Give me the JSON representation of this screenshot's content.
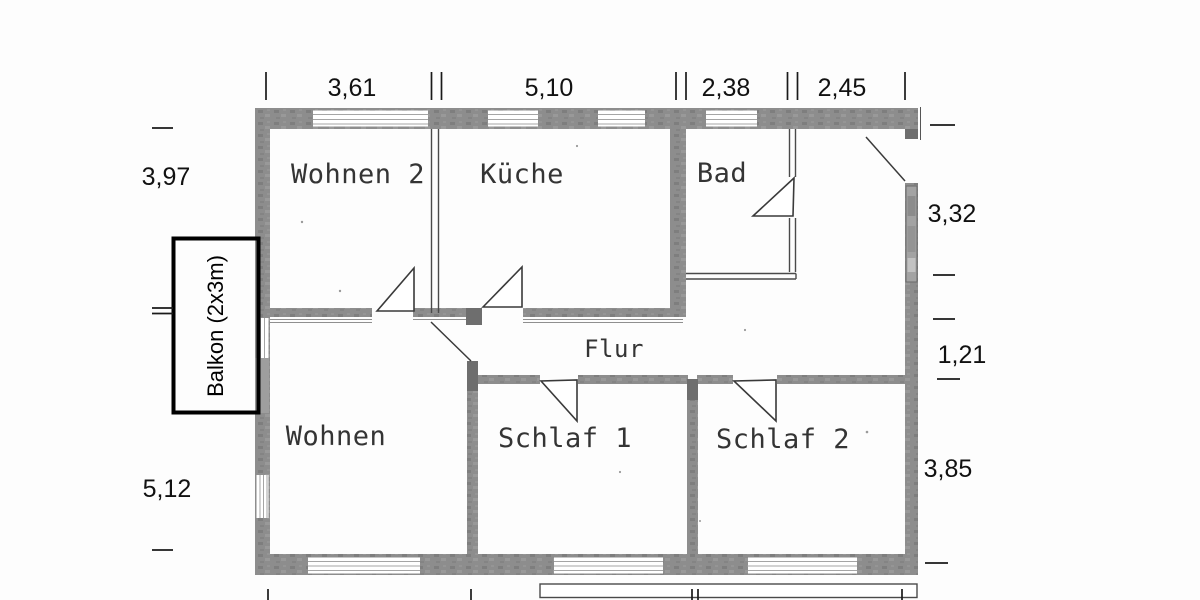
{
  "rooms": {
    "wohnen2": "Wohnen 2",
    "kueche": "Küche",
    "bad": "Bad",
    "flur": "Flur",
    "wohnen": "Wohnen",
    "schlaf1": "Schlaf 1",
    "schlaf2": "Schlaf 2"
  },
  "balcony": {
    "label": "Balkon (2x3m)"
  },
  "dimensions": {
    "top": [
      "3,61",
      "5,10",
      "2,38",
      "2,45"
    ],
    "left": [
      "3,97",
      "5,12"
    ],
    "right": [
      "3,32",
      "1,21",
      "3,85"
    ]
  },
  "colors": {
    "background": "#fdfdfd",
    "wall_gray": "#8d8d8d",
    "wall_dark": "#6e6e6e",
    "line_dark": "#3a3a3a",
    "dimension_text": "#111111",
    "balcony_border": "#000000"
  }
}
